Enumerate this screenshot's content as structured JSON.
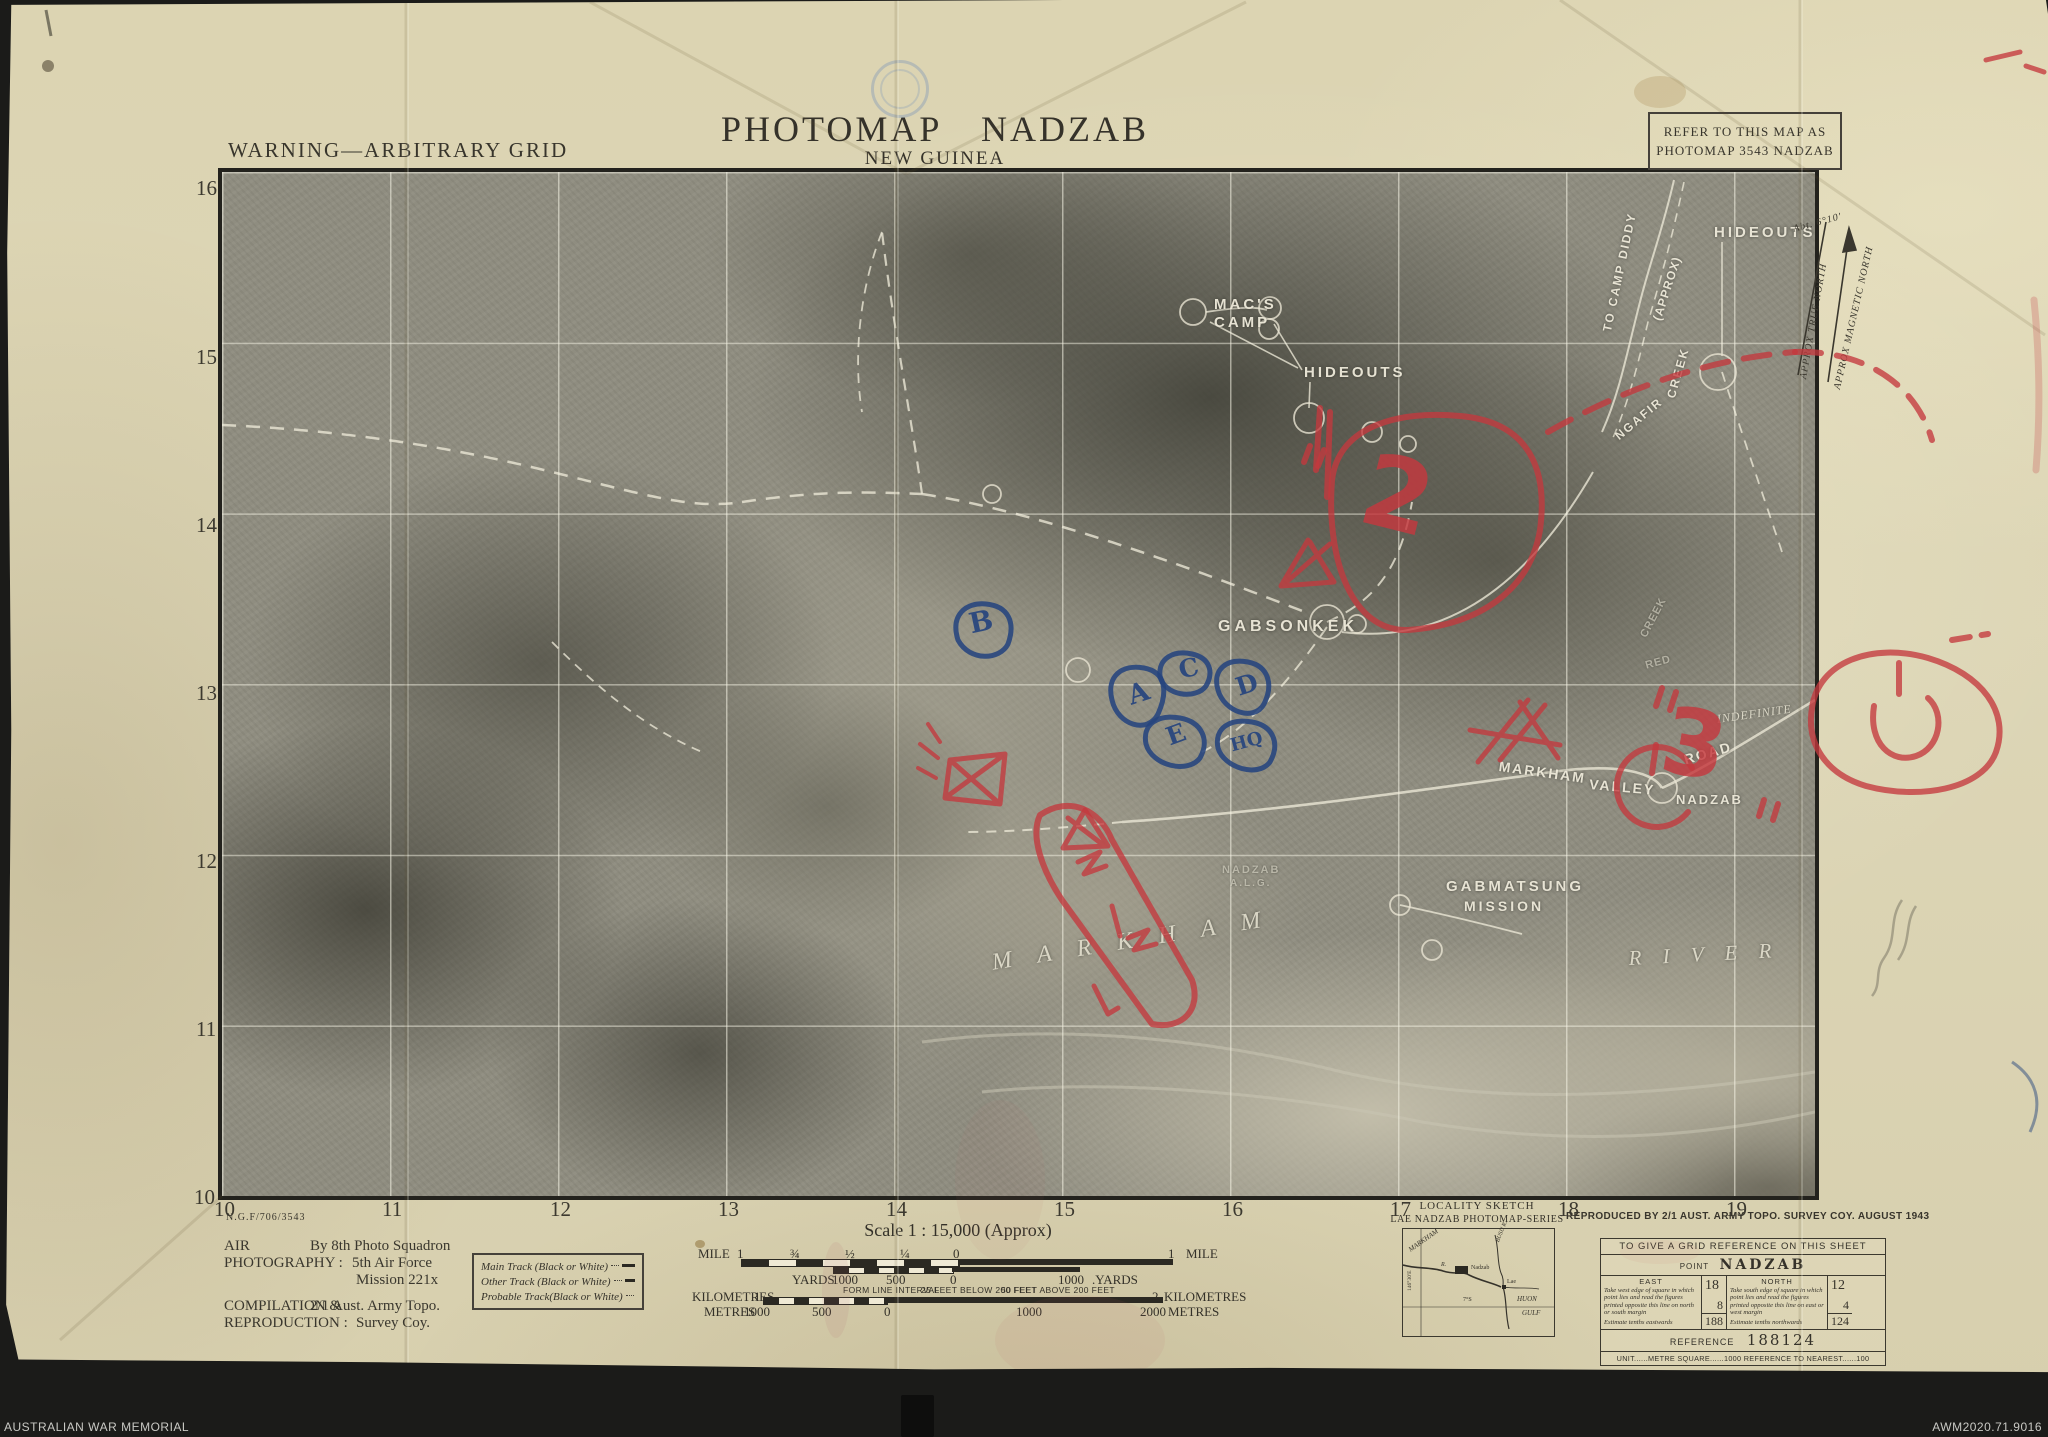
{
  "archive_bar": {
    "left": "AUSTRALIAN WAR MEMORIAL",
    "right": "AWM2020.71.9016"
  },
  "header": {
    "warning": "WARNING—ARBITRARY GRID",
    "title": "PHOTOMAP NADZAB",
    "subtitle": "NEW GUINEA",
    "refer_line1": "REFER TO THIS MAP AS",
    "refer_line2": "PHOTOMAP 3543 NADZAB"
  },
  "grid": {
    "left_labels": [
      {
        "t": "16",
        "x": 196,
        "y": 176,
        "cls": "gridnum"
      },
      {
        "t": "15",
        "x": 196,
        "y": 345,
        "cls": "gridnum"
      },
      {
        "t": "14",
        "x": 196,
        "y": 513,
        "cls": "gridnum"
      },
      {
        "t": "13",
        "x": 196,
        "y": 681,
        "cls": "gridnum"
      },
      {
        "t": "12",
        "x": 196,
        "y": 849,
        "cls": "gridnum"
      },
      {
        "t": "11",
        "x": 196,
        "y": 1017,
        "cls": "gridnum"
      },
      {
        "t": "10",
        "x": 194,
        "y": 1185,
        "cls": "gridnum"
      }
    ],
    "bottom_labels": [
      {
        "t": "10",
        "x": 214,
        "y": 1197,
        "cls": "gridnum"
      },
      {
        "t": "11",
        "x": 382,
        "y": 1197,
        "cls": "gridnum"
      },
      {
        "t": "12",
        "x": 550,
        "y": 1197,
        "cls": "gridnum"
      },
      {
        "t": "13",
        "x": 718,
        "y": 1197,
        "cls": "gridnum"
      },
      {
        "t": "14",
        "x": 886,
        "y": 1197,
        "cls": "gridnum"
      },
      {
        "t": "15",
        "x": 1054,
        "y": 1197,
        "cls": "gridnum"
      },
      {
        "t": "16",
        "x": 1222,
        "y": 1197,
        "cls": "gridnum"
      },
      {
        "t": "17",
        "x": 1390,
        "y": 1197,
        "cls": "gridnum"
      },
      {
        "t": "18",
        "x": 1558,
        "y": 1197,
        "cls": "gridnum"
      },
      {
        "t": "19",
        "x": 1726,
        "y": 1197,
        "cls": "gridnum"
      }
    ]
  },
  "photo_labels": [
    {
      "t": "MAC'S",
      "x": 1214,
      "y": 296,
      "fs": 15,
      "ls": 3,
      "cls": "photo-lab"
    },
    {
      "t": "CAMP",
      "x": 1214,
      "y": 314,
      "fs": 15,
      "ls": 3,
      "cls": "photo-lab"
    },
    {
      "t": "HIDEOUTS",
      "x": 1304,
      "y": 364,
      "fs": 15,
      "ls": 3,
      "cls": "photo-lab"
    },
    {
      "t": "HIDEOUTS",
      "x": 1714,
      "y": 224,
      "fs": 15,
      "ls": 3,
      "cls": "photo-lab"
    },
    {
      "t": "GABSONKEK",
      "x": 1218,
      "y": 618,
      "fs": 16,
      "ls": 4,
      "cls": "photo-lab"
    },
    {
      "t": "MARKHAM",
      "x": 1500,
      "y": 758,
      "fs": 14,
      "ls": 2,
      "rot": 8,
      "cls": "photo-lab"
    },
    {
      "t": "VALLEY",
      "x": 1590,
      "y": 776,
      "fs": 14,
      "ls": 2,
      "rot": 5,
      "cls": "photo-lab"
    },
    {
      "t": "ROAD",
      "x": 1682,
      "y": 752,
      "fs": 14,
      "ls": 2,
      "rot": -16,
      "cls": "photo-lab"
    },
    {
      "t": "NADZAB",
      "x": 1676,
      "y": 792,
      "fs": 13,
      "ls": 2,
      "cls": "photo-lab"
    },
    {
      "t": "GABMATSUNG",
      "x": 1446,
      "y": 878,
      "fs": 15,
      "ls": 3,
      "cls": "photo-lab"
    },
    {
      "t": "MISSION",
      "x": 1464,
      "y": 898,
      "fs": 14,
      "ls": 3,
      "cls": "photo-lab"
    },
    {
      "t": "NADZAB",
      "x": 1222,
      "y": 864,
      "fs": 11,
      "ls": 2,
      "cls": "photo-dim"
    },
    {
      "t": "A.L.G.",
      "x": 1230,
      "y": 878,
      "fs": 10,
      "ls": 2,
      "cls": "photo-dim"
    },
    {
      "t": "M A R K H A M",
      "x": 990,
      "y": 950,
      "fs": 24,
      "ls": 10,
      "rot": -9,
      "cls": "photo-it"
    },
    {
      "t": "R I V E R",
      "x": 1628,
      "y": 946,
      "fs": 21,
      "ls": 8,
      "rot": -3,
      "cls": "photo-it"
    },
    {
      "t": "TO CAMP DIDDY",
      "x": 1600,
      "y": 330,
      "fs": 12,
      "ls": 2,
      "rot": -78,
      "cls": "photo-lab"
    },
    {
      "t": "(APPROX)",
      "x": 1650,
      "y": 318,
      "fs": 12,
      "ls": 1,
      "rot": -72,
      "cls": "photo-lab"
    },
    {
      "t": "CREEK",
      "x": 1664,
      "y": 396,
      "fs": 12,
      "ls": 2,
      "rot": -74,
      "cls": "photo-lab"
    },
    {
      "t": "NGAFIR",
      "x": 1612,
      "y": 432,
      "fs": 12,
      "ls": 2,
      "rot": -40,
      "cls": "photo-lab"
    },
    {
      "t": "CREEK",
      "x": 1638,
      "y": 634,
      "fs": 11,
      "ls": 1,
      "rot": -62,
      "cls": "photo-dim"
    },
    {
      "t": "RED",
      "x": 1644,
      "y": 660,
      "fs": 11,
      "ls": 1,
      "rot": -15,
      "cls": "photo-dim"
    },
    {
      "t": "INDEFINITE",
      "x": 1716,
      "y": 712,
      "fs": 12,
      "ls": 1,
      "rot": -8,
      "cls": "photo-it"
    }
  ],
  "north": [
    {
      "t": "Abt. 6°10′",
      "x": 1792,
      "y": 224,
      "rot": -15,
      "cls": "north-t"
    },
    {
      "t": "APPROX TRUE NORTH",
      "x": 1798,
      "y": 378,
      "rot": -80,
      "cls": "north-t"
    },
    {
      "t": "APPROX MAGNETIC NORTH",
      "x": 1832,
      "y": 388,
      "rot": -77,
      "cls": "north-t"
    }
  ],
  "hand_marks": [
    {
      "t": "2",
      "x": 1378,
      "y": 430,
      "fs": 100,
      "rot": 14,
      "cls": "red-note"
    },
    {
      "t": "3",
      "x": 1672,
      "y": 686,
      "fs": 92,
      "rot": 10,
      "cls": "red-note"
    },
    {
      "t": "B",
      "x": 966,
      "y": 608,
      "fs": 28,
      "rot": -12,
      "cls": "blue-note"
    },
    {
      "t": "A",
      "x": 1124,
      "y": 682,
      "fs": 27,
      "rot": -18,
      "cls": "blue-note"
    },
    {
      "t": "C",
      "x": 1176,
      "y": 656,
      "fs": 25,
      "rot": -12,
      "cls": "blue-note"
    },
    {
      "t": "D",
      "x": 1232,
      "y": 674,
      "fs": 25,
      "rot": -18,
      "cls": "blue-note"
    },
    {
      "t": "E",
      "x": 1162,
      "y": 724,
      "fs": 25,
      "rot": -20,
      "cls": "blue-note"
    },
    {
      "t": "HQ",
      "x": 1228,
      "y": 736,
      "fs": 18,
      "rot": -15,
      "cls": "blue-note"
    }
  ],
  "footer": {
    "plate_no": "N.G.F/706/3543",
    "scale_title": "Scale 1 : 15,000 (Approx)",
    "credit_lines": [
      {
        "t": "AIR",
        "x": 224,
        "y": 1238,
        "cls": "credit"
      },
      {
        "t": "PHOTOGRAPHY :",
        "x": 224,
        "y": 1255,
        "cls": "credit"
      },
      {
        "t": "By 8th Photo Squadron",
        "x": 310,
        "y": 1238,
        "cls": "credit"
      },
      {
        "t": "5th Air Force",
        "x": 352,
        "y": 1255,
        "cls": "credit"
      },
      {
        "t": "Mission 221x",
        "x": 356,
        "y": 1272,
        "cls": "credit"
      },
      {
        "t": "COMPILATION &",
        "x": 224,
        "y": 1298,
        "cls": "credit"
      },
      {
        "t": "2/1 Aust. Army Topo.",
        "x": 310,
        "y": 1298,
        "cls": "credit"
      },
      {
        "t": "REPRODUCTION :",
        "x": 224,
        "y": 1315,
        "cls": "credit"
      },
      {
        "t": "Survey Coy.",
        "x": 356,
        "y": 1315,
        "cls": "credit"
      }
    ],
    "legend": [
      {
        "label": "Main Track (Black or White)",
        "style": "solid"
      },
      {
        "label": "Other Track (Black or White)",
        "style": "dash-long"
      },
      {
        "label": "Probable Track(Black or White)",
        "style": "dash-short"
      }
    ],
    "bar_labels": [
      {
        "t": "MILE",
        "x": 698,
        "y": 1246,
        "cls": "bar-lab"
      },
      {
        "t": "1",
        "x": 737,
        "y": 1246,
        "cls": "bar-lab"
      },
      {
        "t": "¾",
        "x": 790,
        "y": 1246,
        "cls": "bar-lab"
      },
      {
        "t": "½",
        "x": 845,
        "y": 1246,
        "cls": "bar-lab"
      },
      {
        "t": "¼",
        "x": 900,
        "y": 1246,
        "cls": "bar-lab"
      },
      {
        "t": "0",
        "x": 953,
        "y": 1246,
        "cls": "bar-lab"
      },
      {
        "t": "1",
        "x": 1168,
        "y": 1246,
        "cls": "bar-lab"
      },
      {
        "t": "MILE",
        "x": 1186,
        "y": 1246,
        "cls": "bar-lab"
      },
      {
        "t": "YARDS",
        "x": 792,
        "y": 1272,
        "cls": "bar-lab"
      },
      {
        "t": "1000",
        "x": 832,
        "y": 1272,
        "cls": "bar-lab"
      },
      {
        "t": "500",
        "x": 886,
        "y": 1272,
        "cls": "bar-lab"
      },
      {
        "t": "0",
        "x": 950,
        "y": 1272,
        "cls": "bar-lab"
      },
      {
        "t": "1000",
        "x": 1058,
        "y": 1272,
        "cls": "bar-lab"
      },
      {
        "t": ".YARDS",
        "x": 1092,
        "y": 1272,
        "cls": "bar-lab"
      },
      {
        "t": "FORM LINE INTERVAL",
        "x": 843,
        "y": 1285,
        "cls": "bar-sm"
      },
      {
        "t": "25 FEET BELOW 200 FEET",
        "x": 921,
        "y": 1285,
        "cls": "bar-sm"
      },
      {
        "t": "50 FEET ABOVE 200 FEET",
        "x": 1001,
        "y": 1285,
        "cls": "bar-sm"
      },
      {
        "t": "KILOMETRES",
        "x": 692,
        "y": 1289,
        "cls": "bar-lab"
      },
      {
        "t": "1",
        "x": 754,
        "y": 1289,
        "cls": "bar-lab"
      },
      {
        "t": "2",
        "x": 1152,
        "y": 1289,
        "cls": "bar-lab"
      },
      {
        "t": "KILOMETRES",
        "x": 1164,
        "y": 1289,
        "cls": "bar-lab"
      },
      {
        "t": "METRES",
        "x": 704,
        "y": 1304,
        "cls": "bar-lab"
      },
      {
        "t": "1000",
        "x": 744,
        "y": 1304,
        "cls": "bar-lab"
      },
      {
        "t": "500",
        "x": 812,
        "y": 1304,
        "cls": "bar-lab"
      },
      {
        "t": "0",
        "x": 884,
        "y": 1304,
        "cls": "bar-lab"
      },
      {
        "t": "1000",
        "x": 1016,
        "y": 1304,
        "cls": "bar-lab"
      },
      {
        "t": "2000",
        "x": 1140,
        "y": 1304,
        "cls": "bar-lab"
      },
      {
        "t": "METRES",
        "x": 1168,
        "y": 1304,
        "cls": "bar-lab"
      }
    ],
    "locality": {
      "title": "LOCALITY SKETCH",
      "series": "LAE NADZAB PHOTOMAP-SERIES",
      "labels": [
        {
          "t": "MARKHAM",
          "x": 4,
          "y": 18,
          "fs": 7,
          "rot": -35,
          "cls": "loc-it"
        },
        {
          "t": "R.",
          "x": 38,
          "y": 33,
          "fs": 6,
          "cls": "loc-it"
        },
        {
          "t": "Nadzab",
          "x": 68,
          "y": 36,
          "fs": 6,
          "cls": "loc-pl"
        },
        {
          "t": "BUSU R.",
          "x": 92,
          "y": 12,
          "fs": 6,
          "rot": -68,
          "cls": "loc-it"
        },
        {
          "t": "Lae",
          "x": 104,
          "y": 50,
          "fs": 6,
          "cls": "loc-pl"
        },
        {
          "t": "HUON",
          "x": 114,
          "y": 66,
          "fs": 7,
          "cls": "loc-it"
        },
        {
          "t": "GULF",
          "x": 119,
          "y": 80,
          "fs": 7,
          "cls": "loc-it"
        },
        {
          "t": "7°S",
          "x": 60,
          "y": 68,
          "fs": 6,
          "cls": "loc-pl"
        },
        {
          "t": "146°30′E",
          "x": 4,
          "y": 62,
          "fs": 5.5,
          "rot": -90,
          "cls": "loc-pl"
        }
      ]
    },
    "reproduced": "REPRODUCED BY 2/1 AUST. ARMY TOPO. SURVEY COY. AUGUST 1943",
    "gridref": {
      "title": "TO GIVE A GRID REFERENCE ON THIS SHEET",
      "point_label": "POINT",
      "point_value": "NADZAB",
      "east_header": "EAST",
      "east_text": "Take west edge of square in which point lies and read the figures printed opposite this line on north or south margin",
      "east_estimate": "Estimate tenths eastwards",
      "east_big": "18",
      "east_small": "8",
      "east_combined": "188",
      "north_header": "NORTH",
      "north_text": "Take south edge of square in which point lies and read the figures printed opposite this line on east or west margin",
      "north_estimate": "Estimate tenths northwards",
      "north_big": "12",
      "north_small": "4",
      "north_combined": "124",
      "reference_label": "REFERENCE",
      "reference_value": "188124",
      "unit_line": "UNIT......METRE   SQUARE......1000   REFERENCE TO NEAREST......100"
    }
  },
  "colors": {
    "paper": "#ddd5b2",
    "photo_gray": "#8f8d80",
    "annotation_red": "#c4383e",
    "annotation_blue": "#26447e",
    "ink": "#35322a"
  }
}
